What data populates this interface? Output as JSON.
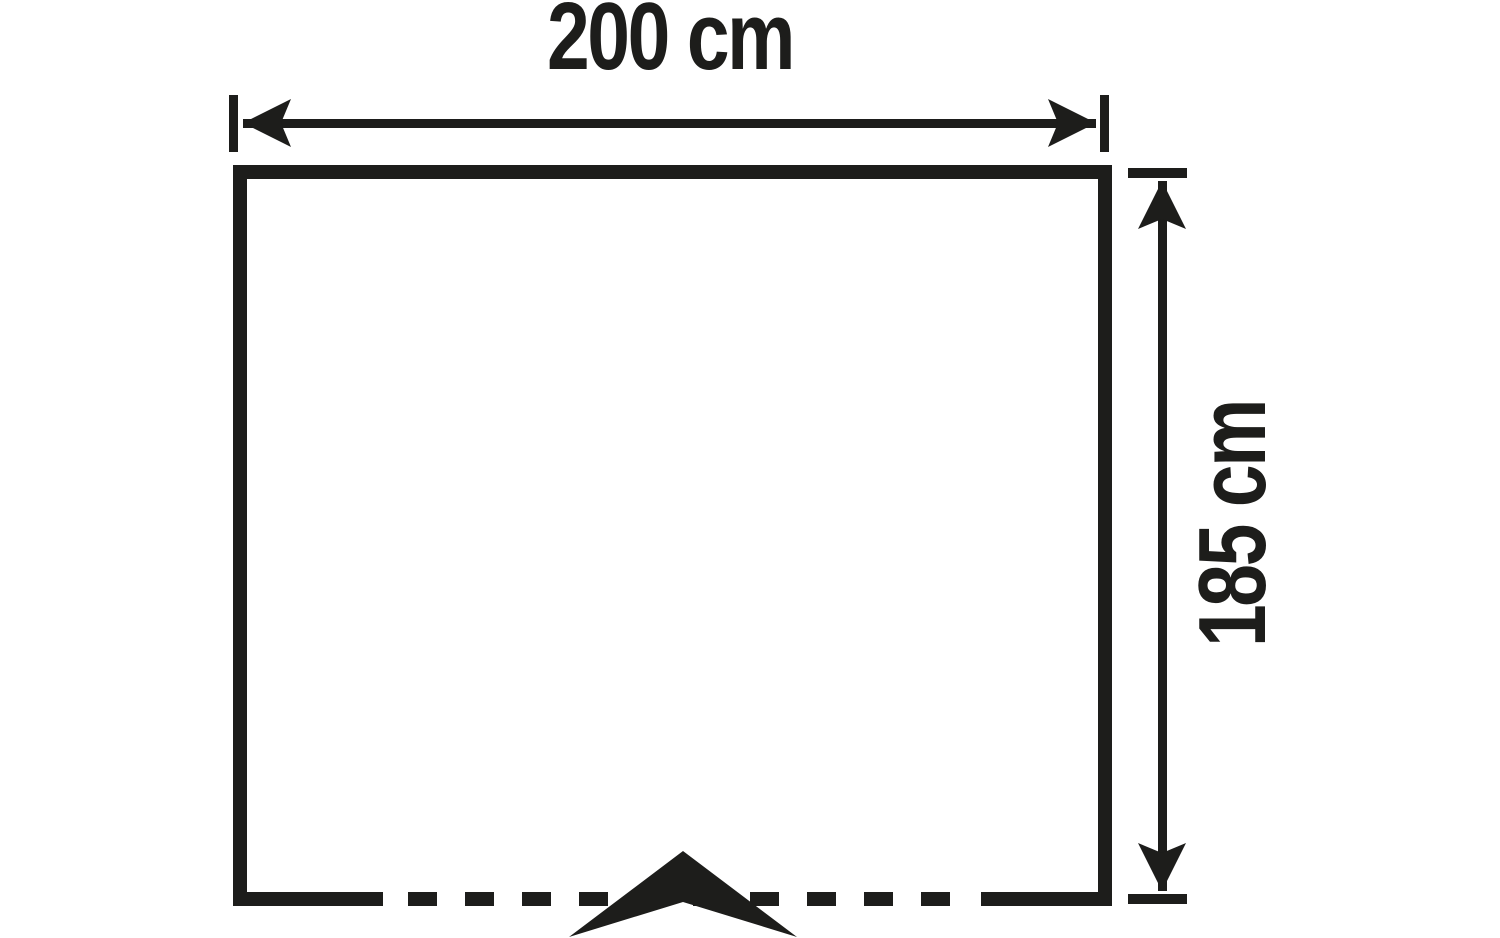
{
  "theme": {
    "ink": "#1d1d1b",
    "background": "#ffffff"
  },
  "diagram": {
    "type": "dimension-drawing",
    "shape": "rectangle-footprint",
    "width_label": "200 cm",
    "height_label": "185 cm",
    "width_value_cm": 200,
    "height_value_cm": 185,
    "icons": {
      "entrance_marker": "tent-entrance-chevron-icon",
      "width_arrow": "double-headed-horizontal-arrow",
      "height_arrow": "double-headed-vertical-arrow"
    },
    "bottom_edge_style": "dashed-with-entrance-marker"
  }
}
